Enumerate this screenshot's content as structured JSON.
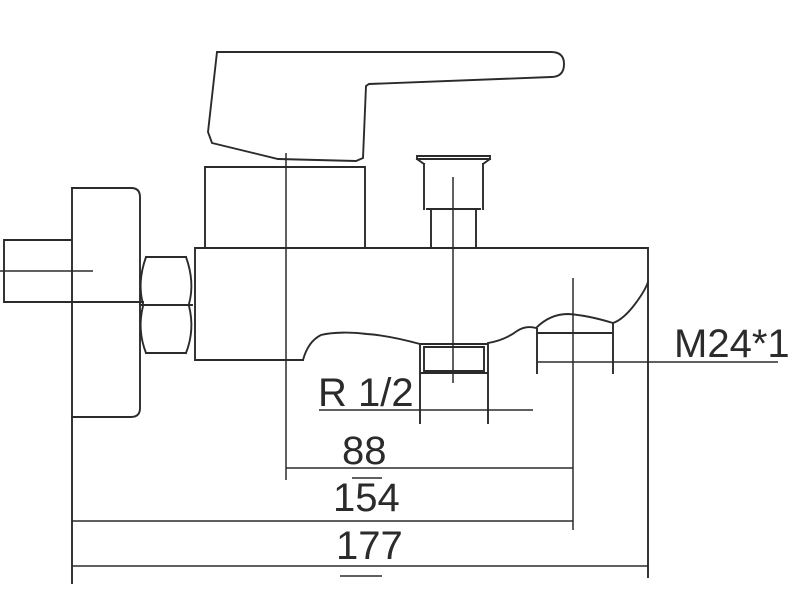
{
  "colors": {
    "line": "#2b2b2b",
    "background": "#ffffff"
  },
  "thread_labels": {
    "shower_connector": "M24*1",
    "spout_connector": "R 1/2"
  },
  "dimension_labels": [
    "88",
    "154",
    "177"
  ]
}
